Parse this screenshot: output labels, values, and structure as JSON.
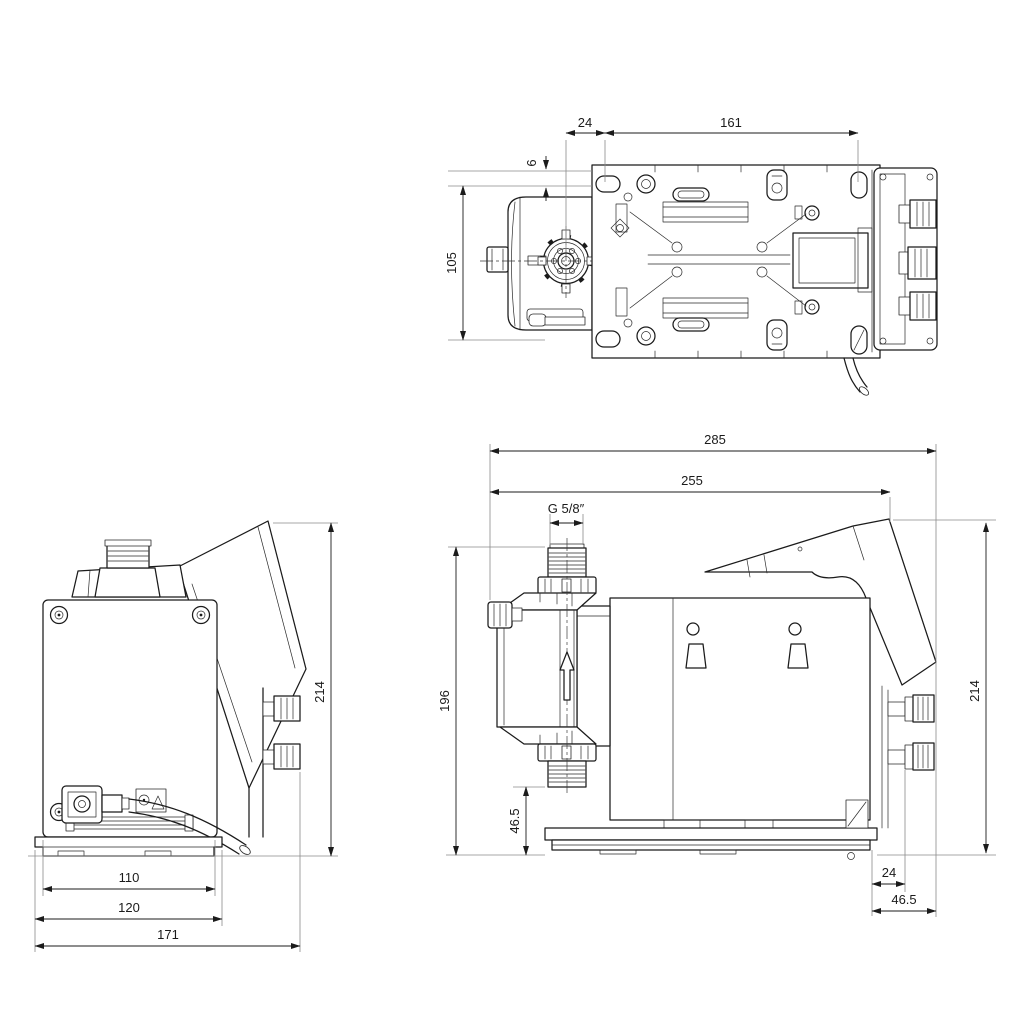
{
  "drawing": {
    "background": "#ffffff",
    "line_color": "#1b1b1b",
    "extension_line_color": "#8a8a8a",
    "views": {
      "top": {
        "dims": {
          "hole_offset": "24",
          "hole_spacing": "161",
          "hole_edge_offset": "6",
          "mounting_width": "105"
        }
      },
      "rear": {
        "dims": {
          "plate_width": "110",
          "base_width": "120",
          "overall_width": "171",
          "overall_height": "214"
        }
      },
      "side": {
        "dims": {
          "overall_length": "285",
          "length_to_panel": "255",
          "thread_size": "G 5/8″",
          "suction_height": "196",
          "thread_clearance": "46.5",
          "overall_height": "214",
          "knob_offset": "24",
          "knob_face_offset": "46.5"
        }
      }
    }
  }
}
